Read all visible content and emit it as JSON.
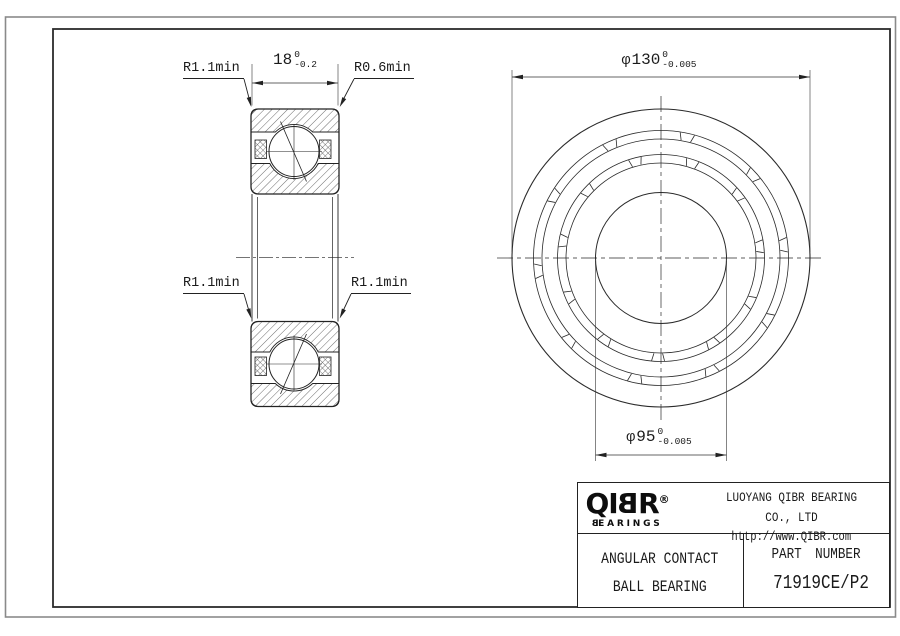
{
  "page": {
    "background": "#ffffff",
    "line_color": "#222222",
    "frame_color": "#8a8a8a"
  },
  "dimensions": {
    "width": {
      "value": "18",
      "tol_upper": "0",
      "tol_lower": "-0.2"
    },
    "outer_diameter": {
      "prefix": "φ",
      "value": "130",
      "tol_upper": "0",
      "tol_lower": "-0.005"
    },
    "bore_diameter": {
      "prefix": "φ",
      "value": "95",
      "tol_upper": "0",
      "tol_lower": "-0.005"
    }
  },
  "callouts": {
    "top_left": "R1.1min",
    "top_right": "R0.6min",
    "mid_left": "R1.1min",
    "mid_right": "R1.1min"
  },
  "title_block": {
    "logo": {
      "pre": "QI",
      "mirrored_letter": "B",
      "post": "R",
      "registered": "®",
      "sub_mirrored": "B",
      "sub_post": "EARINGS"
    },
    "company": "LUOYANG QIBR BEARING CO., LTD",
    "website": "http://www.QIBR.com",
    "product_line1": "ANGULAR CONTACT",
    "product_line2": "BALL BEARING",
    "part_label": "PART NUMBER",
    "part_number": "71919CE/P2"
  }
}
